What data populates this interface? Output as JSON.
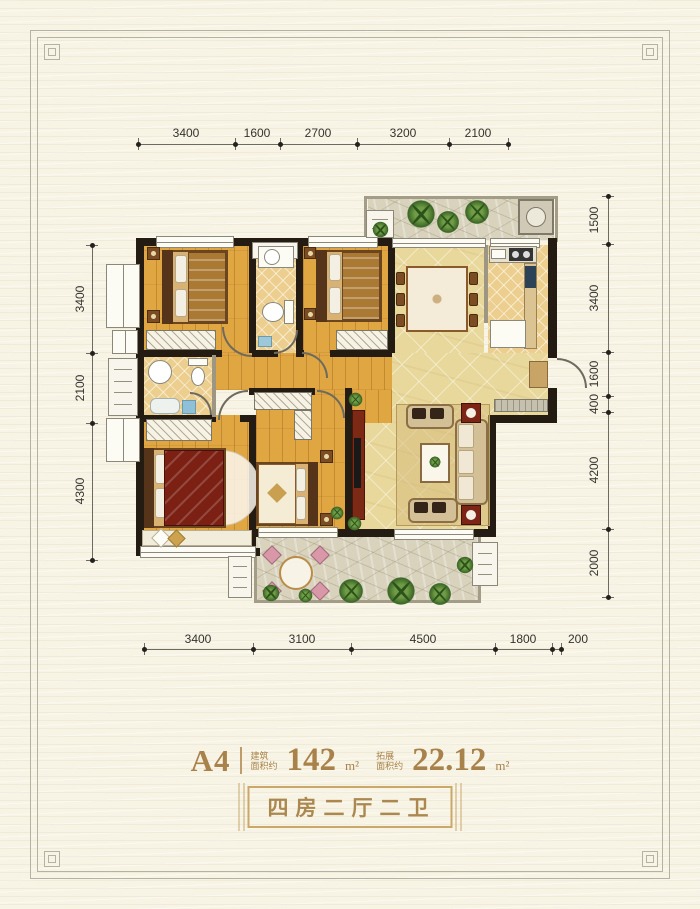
{
  "floorplan": {
    "unit_name": "A4",
    "area": {
      "building_label": "建筑",
      "building_sublabel": "面积约",
      "building_value": "142",
      "building_unit": "m²",
      "expansion_label": "拓展",
      "expansion_sublabel": "面积约",
      "expansion_value": "22.12",
      "expansion_unit": "m²"
    },
    "layout_tag": "四房二厅二卫",
    "dimensions": {
      "top": [
        "3400",
        "1600",
        "2700",
        "3200",
        "2100"
      ],
      "left": [
        "3400",
        "2100",
        "4300"
      ],
      "right": [
        "1500",
        "3400",
        "1600",
        "400",
        "4200",
        "2000"
      ],
      "bottom": [
        "3400",
        "3100",
        "4500",
        "1800",
        "200"
      ]
    },
    "colors": {
      "accent_gold": "#a8824a",
      "wall": "#241c12",
      "wood_floor": "#e0a642",
      "hall_floor": "#e9d89c",
      "tile_floor": "#eccf8e",
      "stone_floor": "#d9d3bd",
      "background": "#f8f4e5"
    }
  }
}
